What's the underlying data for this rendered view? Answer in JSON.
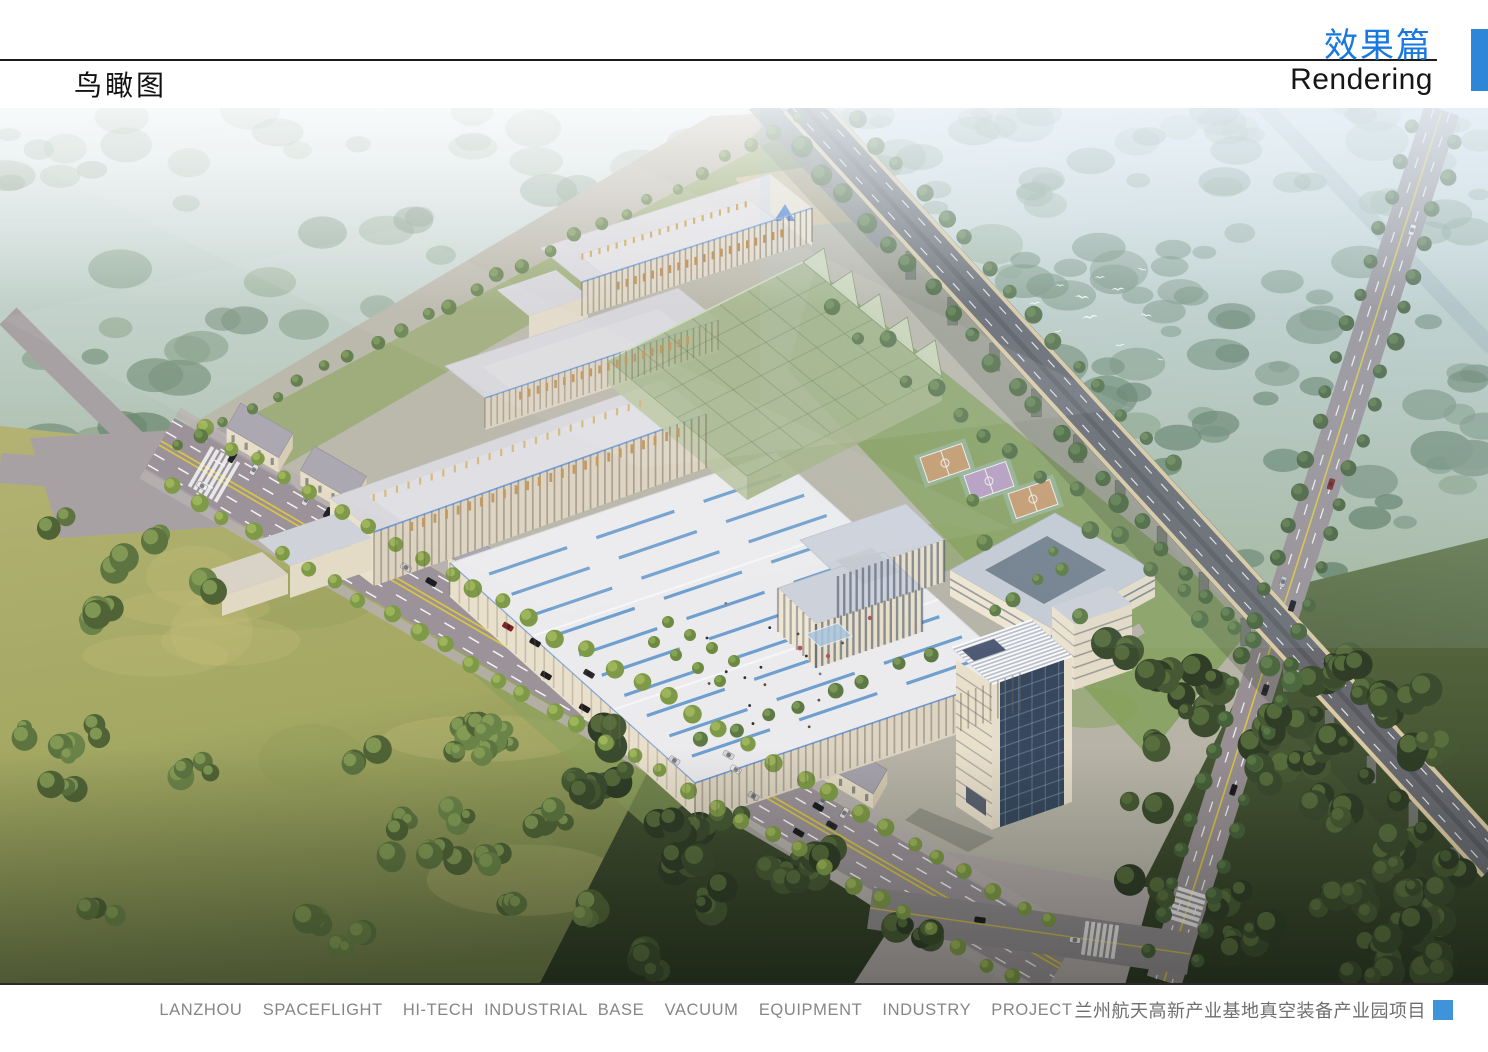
{
  "header": {
    "page_label_cn": "鸟瞰图",
    "section_title_cn": "效果篇",
    "section_title_en": "Rendering"
  },
  "footer": {
    "caption_en": "LANZHOU  SPACEFLIGHT  HI-TECH INDUSTRIAL BASE  VACUUM  EQUIPMENT  INDUSTRY  PROJECT",
    "caption_cn": "兰州航天高新产业基地真空装备产业园项目"
  },
  "colors": {
    "section_title_blue": "#1778e0",
    "header_bar_blue": "#2e86d8",
    "footer_square_blue": "#3f93d8",
    "caption_gray": "#868686",
    "rendering_sky_haze": "#d7e4e8",
    "rendering_grass": "#b9b56c",
    "rendering_roof_skylight_blue": "#6f9fce",
    "rendering_glass_green": "#a2b488",
    "rendering_logo_blue": "#3f74c8"
  }
}
